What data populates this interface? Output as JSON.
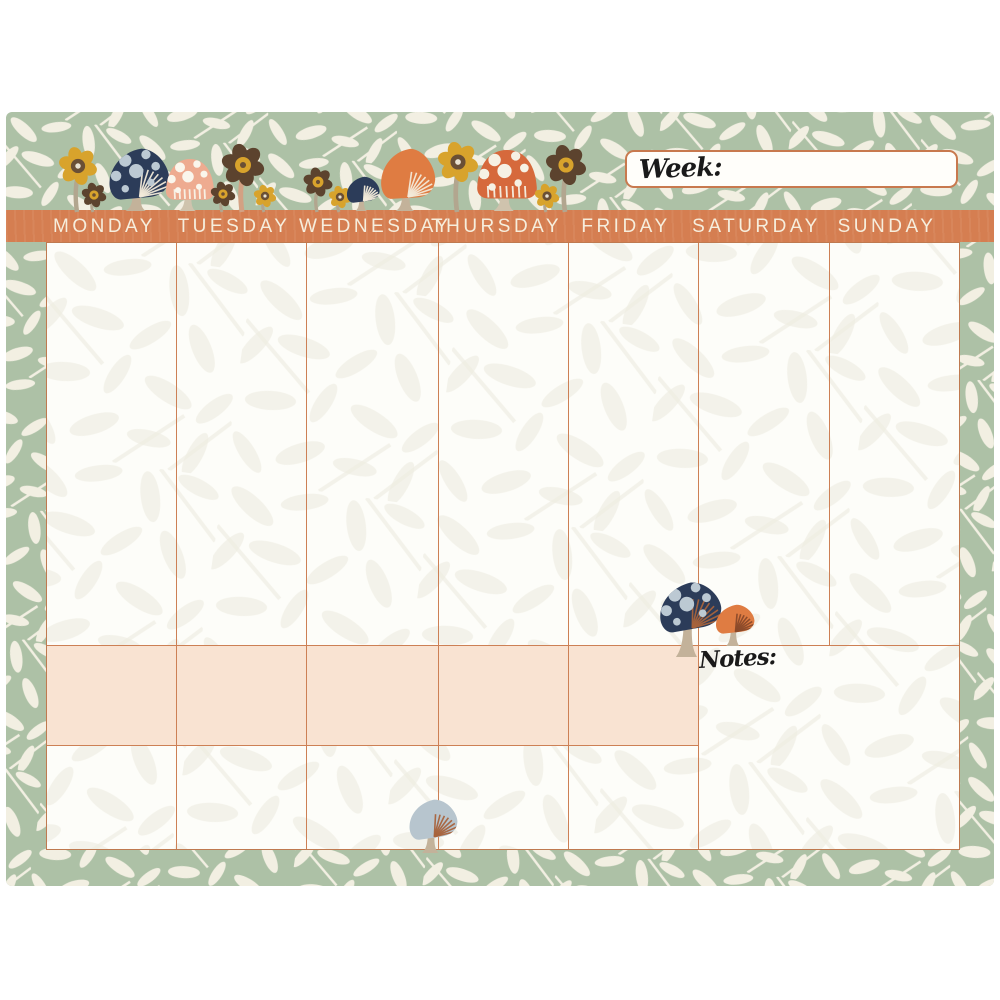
{
  "planner": {
    "title": "Mushroom weekly planner pad",
    "week_field": {
      "label": "Week:",
      "value": ""
    },
    "notes_label": "Notes:",
    "days": [
      "MONDAY",
      "TUESDAY",
      "WEDNESDAY",
      "THURSDAY",
      "FRIDAY",
      "SATURDAY",
      "SUNDAY"
    ],
    "colors": {
      "page_background": "#ffffff",
      "sage_border": "#adc1a6",
      "leaf_cream": "#f2efe2",
      "paper": "#fdfdf9",
      "faint_leaf": "#efede2",
      "bar_orange": "#d57e51",
      "bar_text": "#f6eedd",
      "grid_line": "#cd8055",
      "peach_highlight": "#f9e3d2",
      "navy": "#2c3c59",
      "navy_dots": "#bcc9d3",
      "orange_cap": "#df7c42",
      "red_orange_cap": "#d6693c",
      "peach_cap": "#eeab90",
      "blue_gray_cap": "#b7c5ce",
      "stem_tan": "#c3b29a",
      "yellow": "#d8a32c",
      "brown": "#5c432e",
      "script_ink": "#1a1a1a"
    },
    "decorations": {
      "top_band": [
        {
          "kind": "flower",
          "x": 78,
          "headY": 166,
          "r": 17,
          "petal": "#d8a32c",
          "center": "#6a4f35",
          "dot": "#e9e2d2",
          "stem": "#b2a68f",
          "base": 212
        },
        {
          "kind": "flower",
          "x": 94,
          "headY": 195,
          "r": 11,
          "petal": "#5c432e",
          "center": "#d8a32c",
          "dot": "#6a4f35",
          "stem": "#b2a68f",
          "base": 212
        },
        {
          "kind": "mushroom",
          "x": 139,
          "base": 211,
          "capW": 62,
          "capH": 52,
          "stemH": 10,
          "cap": "#2c3c59",
          "dots": "#bcc9d3",
          "gills": "#f2ead9",
          "stem": "#c3b29a",
          "shape": "tilt",
          "tilt": -5
        },
        {
          "kind": "mushroom",
          "x": 190,
          "base": 211,
          "capW": 50,
          "capH": 42,
          "stemH": 10,
          "cap": "#eeab90",
          "dots": "#faf6ec",
          "gills": "#f7f3e8",
          "stem": "#cfc3ad",
          "shape": "dome",
          "tilt": 0
        },
        {
          "kind": "flower",
          "x": 223,
          "headY": 194,
          "r": 11,
          "petal": "#5c432e",
          "center": "#d8a32c",
          "dot": "#6a4f35",
          "stem": "#b2a68f",
          "base": 212
        },
        {
          "kind": "flower",
          "x": 243,
          "headY": 165,
          "r": 19,
          "petal": "#5c432e",
          "center": "#d8a32c",
          "dot": "#6a4f35",
          "stem": "#d3a183",
          "base": 212
        },
        {
          "kind": "flower",
          "x": 265,
          "headY": 196,
          "r": 10,
          "petal": "#d8a32c",
          "center": "#6a4f35",
          "dot": "#e9e2d2",
          "stem": "#b2a68f",
          "base": 212
        },
        {
          "kind": "flower",
          "x": 318,
          "headY": 182,
          "r": 13,
          "petal": "#5c432e",
          "center": "#d8a32c",
          "dot": "#6a4f35",
          "stem": "#b2a68f",
          "base": 212
        },
        {
          "kind": "flower",
          "x": 340,
          "headY": 197,
          "r": 10,
          "petal": "#d8a32c",
          "center": "#6a4f35",
          "dot": "#e9e2d2",
          "stem": "#b2a68f",
          "base": 212
        },
        {
          "kind": "mushroom",
          "x": 363,
          "base": 211,
          "capW": 34,
          "capH": 26,
          "stemH": 8,
          "cap": "#2c3c59",
          "dots": "",
          "gills": "#f2ead9",
          "stem": "#c3b29a",
          "shape": "tilt",
          "tilt": -7
        },
        {
          "kind": "mushroom",
          "x": 408,
          "base": 211,
          "capW": 56,
          "capH": 52,
          "stemH": 10,
          "cap": "#df7c42",
          "dots": "",
          "gills": "#f2ead9",
          "stem": "#c3b29a",
          "shape": "tilt",
          "tilt": -3
        },
        {
          "kind": "flower",
          "x": 458,
          "headY": 162,
          "r": 18,
          "petal": "#d8a32c",
          "center": "#6a4f35",
          "dot": "#e9e2d2",
          "stem": "#b2a68f",
          "base": 212
        },
        {
          "kind": "mushroom",
          "x": 507,
          "base": 211,
          "capW": 62,
          "capH": 50,
          "stemH": 11,
          "cap": "#d6693c",
          "dots": "#f6f1e4",
          "gills": "#f6f1e4",
          "stem": "#cfc3ad",
          "shape": "dome",
          "tilt": 0
        },
        {
          "kind": "flower",
          "x": 547,
          "headY": 196,
          "r": 11,
          "petal": "#d8a32c",
          "center": "#6a4f35",
          "dot": "#e9e2d2",
          "stem": "#b2a68f",
          "base": 212
        },
        {
          "kind": "flower",
          "x": 566,
          "headY": 165,
          "r": 18,
          "petal": "#5c432e",
          "center": "#d8a32c",
          "dot": "#6a4f35",
          "stem": "#b2a68f",
          "base": 212
        }
      ],
      "notes_cluster": [
        {
          "kind": "mushroom",
          "x": 690,
          "base": 657,
          "capW": 64,
          "capH": 49,
          "stemH": 25,
          "cap": "#2c3c59",
          "dots": "#bcc9d3",
          "gills": "#a8633c",
          "stem": "#c3b29a",
          "shape": "tilt",
          "tilt": -10
        },
        {
          "kind": "mushroom",
          "x": 735,
          "base": 646,
          "capW": 40,
          "capH": 29,
          "stemH": 12,
          "cap": "#df7c42",
          "dots": "",
          "gills": "#8a4a2a",
          "stem": "#c3b29a",
          "shape": "tilt",
          "tilt": -6
        }
      ],
      "bottom_edge": [
        {
          "kind": "mushroom",
          "x": 433,
          "base": 853,
          "capW": 50,
          "capH": 40,
          "stemH": 13,
          "cap": "#b7c5ce",
          "dots": "",
          "gills": "#a8633c",
          "stem": "#c3b29a",
          "shape": "tilt",
          "tilt": -8
        }
      ]
    }
  }
}
